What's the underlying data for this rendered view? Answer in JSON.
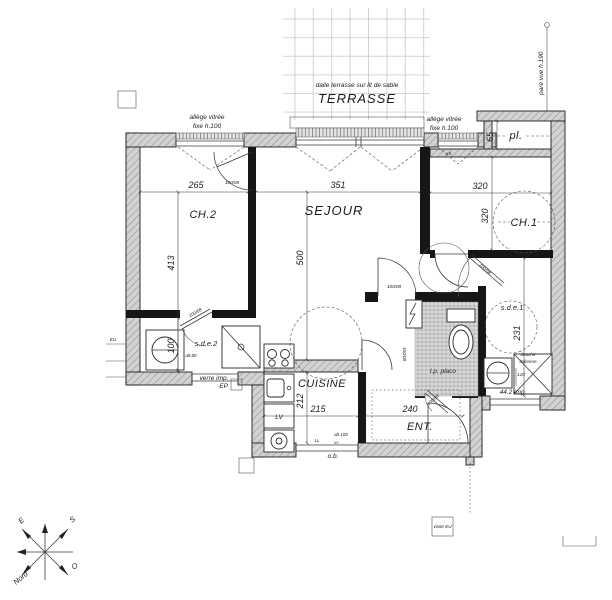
{
  "plan": {
    "rooms": {
      "terrasse": "TERRASSE",
      "ch2": "CH.2",
      "sejour": "SEJOUR",
      "ch1": "CH.1",
      "pl": "pl.",
      "sde2": "s.d.e.2",
      "sde1": "s.d.e.1",
      "cuisine": "CUISINE",
      "ent": "ENT."
    },
    "terrace_note": "dalle terrasse sur lit de sable",
    "annotations": {
      "pare_vue": "pare vue h.190",
      "allege_1": "allège vitrée",
      "allege_2": "fixe h.100",
      "vh": "v.h.",
      "verre_imp": "verre imp.",
      "alt80": "alt.80",
      "alt100": "alt.100",
      "vr": "v.r.",
      "ob": "o.b.",
      "lv": "LV",
      "ll": "LL",
      "ep": "EP",
      "eu": "EU",
      "lp_placo": "l.p. placo",
      "douche_1": "douche",
      "douche_2": "italienne",
      "douche_dim": "120",
      "imp442": "44.2 imp.",
      "visite_eu": "visite EU",
      "door_std": "100/08"
    },
    "dimensions": {
      "d265": "265",
      "d351": "351",
      "d320h": "320",
      "d320v": "320",
      "d413": "413",
      "d500": "500",
      "d100": "100",
      "d212": "212",
      "d215": "215",
      "d240": "240",
      "d231": "231",
      "d65": "65"
    },
    "compass": {
      "n": "Nord",
      "s": "S",
      "o": "O",
      "e": "E"
    }
  }
}
